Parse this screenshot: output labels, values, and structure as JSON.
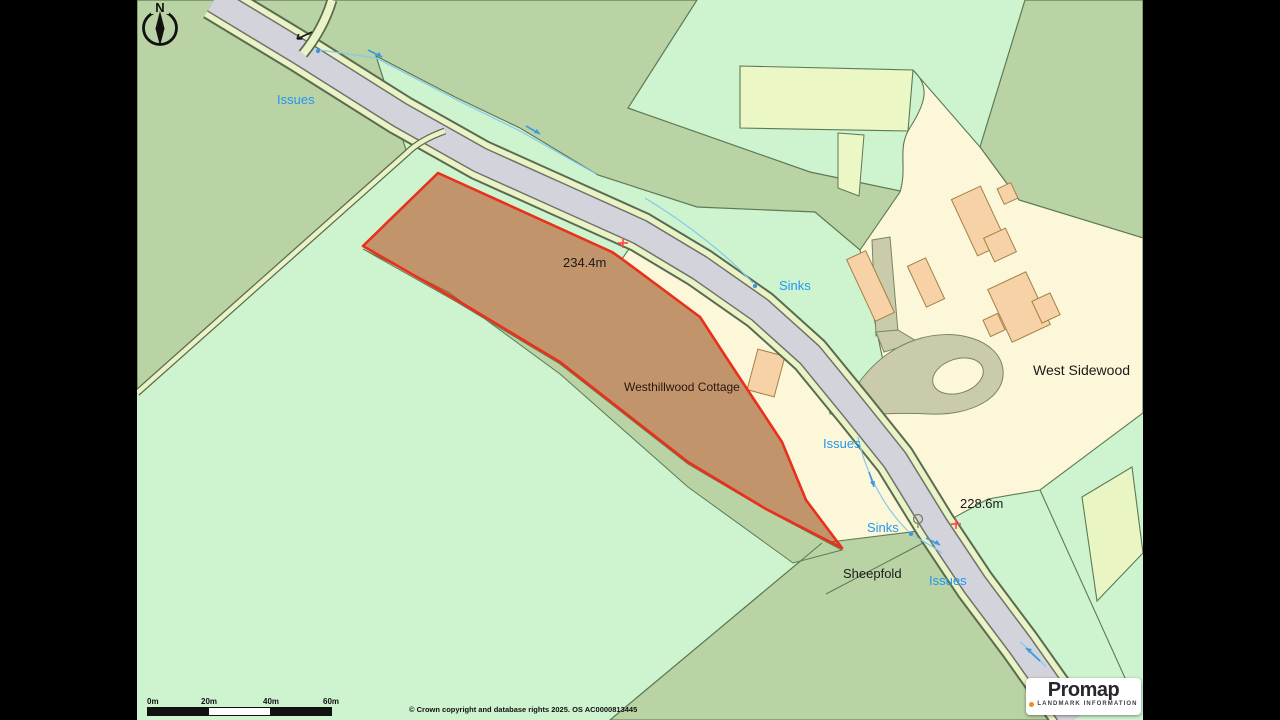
{
  "window": {
    "width": 1280,
    "height": 720,
    "letterbox_color": "#000000"
  },
  "map": {
    "compass": "N",
    "labels": {
      "issues_nw": "Issues",
      "sinks_mid": "Sinks",
      "issues_mid": "Issues",
      "sinks_low": "Sinks",
      "issues_low": "Issues",
      "spot_height_a": "234.4m",
      "spot_height_b": "228.6m",
      "west_sidewood": "West Sidewood",
      "sheepfold": "Sheepfold",
      "westhillwood_cottage": "Westhillwood Cottage"
    },
    "colors": {
      "field_mint": "#cdf3cf",
      "field_sage": "#b9d3a4",
      "field_pale": "#ecf7c6",
      "grounds_cream": "#fcf7d9",
      "building": "#f6d2a6",
      "road_grey": "#d2d3db",
      "verge": "#e9f3c6",
      "driveway": "#cacbaa",
      "boundary_red": "#e8301c",
      "water_blue": "#3a9ae0",
      "label_blue": "#2397f3"
    }
  },
  "scalebar": {
    "ticks": [
      "0m",
      "20m",
      "40m",
      "60m"
    ]
  },
  "attribution": "© Crown copyright and database rights 2025. OS AC0000813445",
  "logo": {
    "brand": "Promap",
    "tagline": "LANDMARK INFORMATION"
  }
}
